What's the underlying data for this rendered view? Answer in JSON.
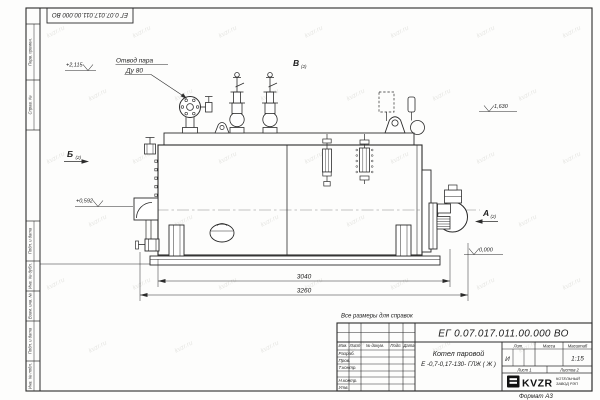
{
  "watermark": {
    "text": "kvzr.ru"
  },
  "frame": {
    "stamp_top": "ЕГ 0.07.017.011.00.000  ВО",
    "side_labels": [
      "Перв. примен.",
      "Справ. №",
      "Подп. и дата",
      "Инв. № дубл.",
      "Взам. инв. №",
      "Подп. и дата",
      "Инв. № подл."
    ],
    "format_note": "Формат А3"
  },
  "drawing": {
    "callout_steam_line1": "Отвод пара",
    "callout_steam_line2": "Ду 80",
    "view_b": "Б",
    "view_b_sub": "(2)",
    "view_v": "В",
    "view_v_sub": "(2)",
    "view_a": "А",
    "view_a_sub": "(2)",
    "elev_top": "+2,115",
    "elev_mid": "+0,592",
    "elev_right": "1,630",
    "elev_zero": "0,000",
    "dim_inner": "3040",
    "dim_outer": "3260"
  },
  "note": "Все размеры для справок",
  "title_block": {
    "doc_number": "ЕГ 0.07.017.011.00.000  ВО",
    "product_line1": "Котел паровой",
    "product_line2": "Е -0,7-0,17-130- ГЛЖ ( Ж )",
    "columns": [
      "Изм.",
      "Лист",
      "№ докум.",
      "Подп.",
      "Дата"
    ],
    "rows": [
      "Разраб.",
      "Пров.",
      "Т.контр.",
      "",
      "Н.контр.",
      "Утв."
    ],
    "lit_label": "Лит.",
    "lit_value": "И",
    "mass_label": "Масса",
    "scale_label": "Масштаб",
    "scale_value": "1:15",
    "sheet": "Лист 1",
    "sheets": "Листов 2",
    "logo_text": "KVZR",
    "logo_caption1": "КОТЕЛЬНЫЙ",
    "logo_caption2": "ЗАВОД РЭП"
  }
}
